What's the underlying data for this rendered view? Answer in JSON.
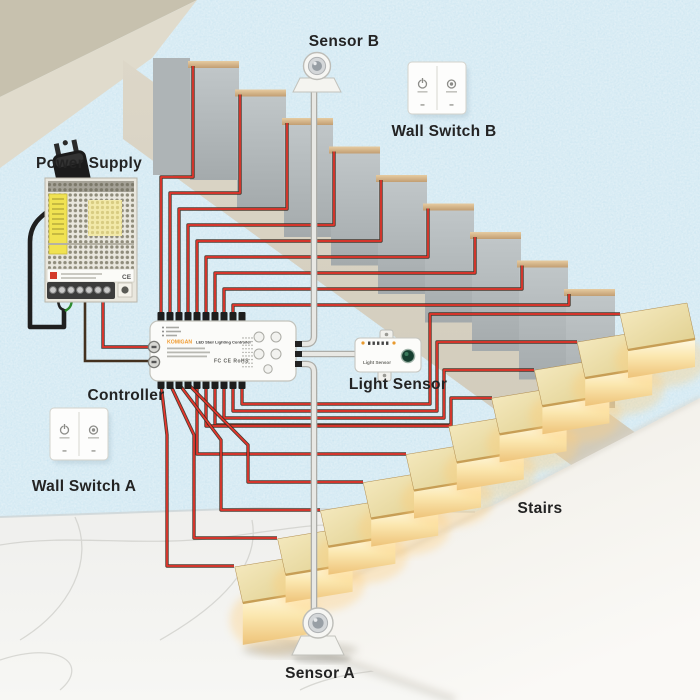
{
  "labels": {
    "power_supply": "Power Supply",
    "sensor_b": "Sensor B",
    "wall_switch_b": "Wall Switch B",
    "controller": "Controller",
    "light_sensor": "Light Sensor",
    "wall_switch_a": "Wall Switch A",
    "stairs": "Stairs",
    "sensor_a": "Sensor A"
  },
  "controller_device": {
    "brand": "KOMIGAN",
    "product": "LED Stair Lighting Controller",
    "certs": "FC CE RoHS"
  },
  "light_sensor_device": {
    "label": "Light Sensor"
  },
  "colors": {
    "wall": "#cde6f1",
    "ceiling_band": "#c7c1ae",
    "upper_steps_gray": "#b4babc",
    "step_nosing_tan": "#d2b084",
    "wire_red": "#e8352b",
    "wire_dark": "#3d2b1f",
    "tread_wood": "#e9d9a2",
    "step_glow": "#ffe9ad",
    "stringer_white": "#f6f4ef",
    "floor_marble": "#f0f0ed",
    "brand_orange": "#f09b2f"
  }
}
